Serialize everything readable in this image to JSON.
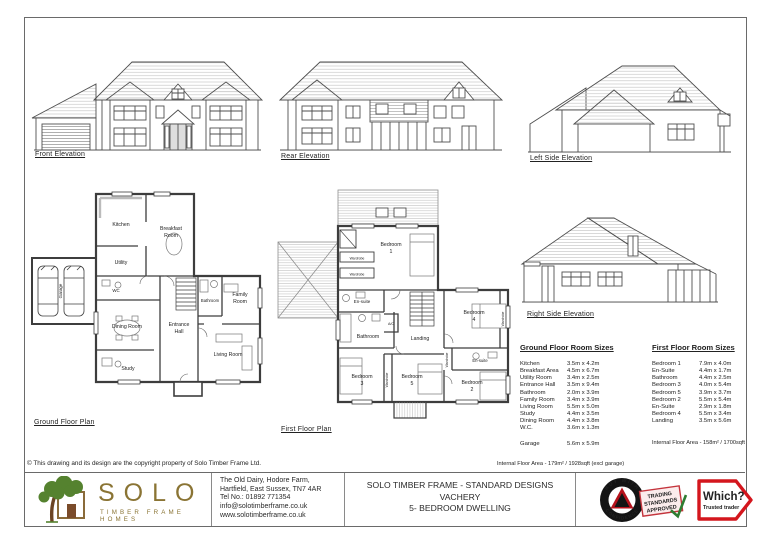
{
  "sheet": {
    "copyright": "© This drawing and its design are the copyright property of Solo Timber Frame Ltd."
  },
  "elevations": {
    "front_label": "Front Elevation",
    "rear_label": "Rear Elevation",
    "left_label": "Left Side Elevation",
    "right_label": "Right Side Elevation"
  },
  "plans": {
    "ground": {
      "label": "Ground Floor Plan",
      "rooms": {
        "kitchen": "Kitchen",
        "breakfast_l1": "Breakfast",
        "breakfast_l2": "Room",
        "utility": "Utility",
        "wc": "WC",
        "bathroom": "Bathroom",
        "family_l1": "Family",
        "family_l2": "Room",
        "dining": "Dining Room",
        "hall_l1": "Entrance",
        "hall_l2": "Hall",
        "study": "Study",
        "living": "Living Room",
        "garage": "Garage"
      }
    },
    "first": {
      "label": "First Floor Plan",
      "rooms": {
        "bedroom": "Bedroom",
        "n1": "1",
        "n2": "2",
        "n3": "3",
        "n4": "4",
        "n5": "5",
        "ensuite": "En-suite",
        "bathroom": "Bathroom",
        "ac": "A/C",
        "landing": "Landing",
        "wardrobe": "Wardrobe"
      }
    }
  },
  "tables": {
    "ground": {
      "title": "Ground Floor Room Sizes",
      "rows": [
        {
          "name": "Kitchen",
          "size": "3.5m x 4.2m"
        },
        {
          "name": "Breakfast Area",
          "size": "4.5m x 6.7m"
        },
        {
          "name": "Utility Room",
          "size": "3.4m x 2.5m"
        },
        {
          "name": "Entrance Hall",
          "size": "3.5m x 9.4m"
        },
        {
          "name": "Bathroom",
          "size": "2.0m x 3.9m"
        },
        {
          "name": "Family Room",
          "size": "3.4m x 3.9m"
        },
        {
          "name": "Living Room",
          "size": "5.5m x 5.0m"
        },
        {
          "name": "Study",
          "size": "4.4m x 3.5m"
        },
        {
          "name": "Dining Room",
          "size": "4.4m x 3.8m"
        },
        {
          "name": "W.C.",
          "size": "3.6m x 1.3m"
        }
      ],
      "garage": {
        "name": "Garage",
        "size": "5.6m x 5.9m"
      },
      "area": "Internal Floor Area - 179m² / 1928sqft (excl garage)"
    },
    "first": {
      "title": "First Floor Room Sizes",
      "rows": [
        {
          "name": "Bedroom 1",
          "size": "7.9m x 4.0m"
        },
        {
          "name": "En-Suite",
          "size": "4.4m x 1.7m"
        },
        {
          "name": "Bathroom",
          "size": "4.4m x 2.5m"
        },
        {
          "name": "Bedroom 3",
          "size": "4.0m x 5.4m"
        },
        {
          "name": "Bedroom 5",
          "size": "3.9m x 3.7m"
        },
        {
          "name": "Bedroom 2",
          "size": "5.5m x 5.4m"
        },
        {
          "name": "En-Suite",
          "size": "2.9m x 1.8m"
        },
        {
          "name": "Bedroom 4",
          "size": "5.5m x 3.4m"
        },
        {
          "name": "Landing",
          "size": "3.5m x 5.6m"
        }
      ],
      "area": "Internal Floor Area - 158m² / 1700sqft"
    }
  },
  "title_block": {
    "logo": {
      "word": "SOLO",
      "tagline": "TIMBER FRAME HOMES"
    },
    "address_lines": [
      "The Old Dairy, Hodore Farm,",
      "Hartfield, East Sussex, TN7 4AR",
      "Tel No.: 01892 771354",
      "info@solotimberframe.co.uk",
      "www.solotimberframe.co.uk"
    ],
    "project_lines": [
      "SOLO TIMBER FRAME - STANDARD DESIGNS",
      "VACHERY",
      "5- BEDROOM DWELLING"
    ],
    "badges": {
      "bwc_top": "BUY WITH",
      "bwc_bottom": "CONFIDENCE",
      "ts_lines": [
        "TRADING",
        "STANDARDS",
        "APPROVED"
      ],
      "which_word": "Which?",
      "which_sub": "Trusted trader"
    }
  },
  "colors": {
    "line": "#4f4f4f",
    "hatch": "#c9c9c9",
    "logo_green": "#55822f",
    "logo_gold": "#8a7434",
    "which_red": "#d4161d",
    "stamp_red": "#c4343c"
  }
}
